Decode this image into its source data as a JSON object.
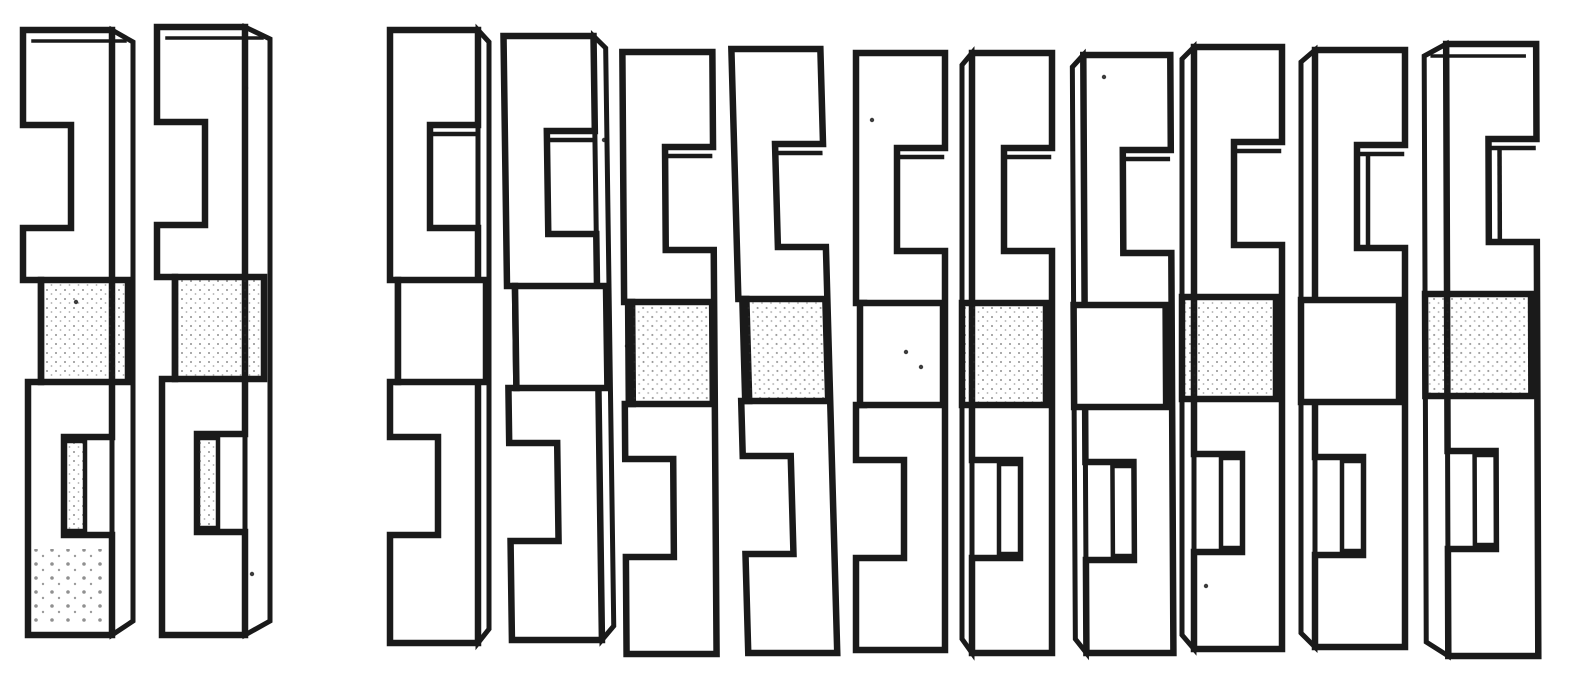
{
  "figure": {
    "kind": "interlocking-s-blocks-diagram",
    "canvas": {
      "width": 1588,
      "height": 676
    },
    "colors": {
      "paper": "#ffffff",
      "ink": "#1a1a1a",
      "stipple": "#333333"
    },
    "template": {
      "top_notch_top": 95,
      "top_notch_bottom": 198,
      "mid_top": 250,
      "mid_bottom": 352,
      "bottom_notch_top": 407,
      "bottom_notch_bottom": 505,
      "notch_depth": 48,
      "stroke": 6.5,
      "detail_stroke": 4.5,
      "thin_stroke": 3.5
    },
    "groups": {
      "left_pair_count": 2,
      "right_chain_count": 10
    },
    "pieces": [
      {
        "id": "piece-1",
        "x": 23,
        "y": 30,
        "w": 89,
        "h": 605,
        "variant": "mirror",
        "depth": "right",
        "dw": 21,
        "skew": 0,
        "shade_mid": true,
        "shade_bottom": true,
        "wall": true,
        "top_face": true
      },
      {
        "id": "piece-2",
        "x": 157,
        "y": 27,
        "w": 88,
        "h": 608,
        "variant": "mirror",
        "depth": "right",
        "dw": 25,
        "skew": 0,
        "shade_mid": true,
        "shade_bottom": false,
        "wall": true,
        "top_face": true
      },
      {
        "id": "piece-3",
        "x": 390,
        "y": 30,
        "w": 88,
        "h": 613,
        "variant": "std",
        "depth": "right",
        "dw": 11,
        "skew": 0,
        "shade_mid": false,
        "shade_bottom": false,
        "wall": false,
        "top_face": false
      },
      {
        "id": "piece-4",
        "x": 503,
        "y": 36,
        "w": 90,
        "h": 604,
        "variant": "std",
        "depth": "right",
        "dw": 12,
        "skew": 0.8,
        "shade_mid": false,
        "shade_bottom": false,
        "wall": false,
        "top_face": false
      },
      {
        "id": "piece-5",
        "x": 622,
        "y": 52,
        "w": 90,
        "h": 602,
        "variant": "std",
        "depth": "none",
        "dw": 0,
        "skew": 0.4,
        "shade_mid": true,
        "shade_bottom": false,
        "wall": false,
        "top_face": false
      },
      {
        "id": "piece-6",
        "x": 730,
        "y": 49,
        "w": 89,
        "h": 604,
        "variant": "std",
        "depth": "none",
        "dw": 0,
        "skew": 1.6,
        "shade_mid": true,
        "shade_bottom": false,
        "wall": false,
        "top_face": false
      },
      {
        "id": "piece-7",
        "x": 856,
        "y": 53,
        "w": 89,
        "h": 597,
        "variant": "std",
        "depth": "none",
        "dw": 0,
        "skew": 0,
        "shade_mid": false,
        "shade_bottom": false,
        "wall": false,
        "top_face": false
      },
      {
        "id": "piece-8",
        "x": 972,
        "y": 53,
        "w": 80,
        "h": 600,
        "variant": "std",
        "depth": "left",
        "dw": 10,
        "skew": 0,
        "shade_mid": true,
        "shade_bottom": false,
        "wall": true,
        "top_face": false
      },
      {
        "id": "piece-9",
        "x": 1083,
        "y": 55,
        "w": 87,
        "h": 598,
        "variant": "std",
        "depth": "left",
        "dw": 11,
        "skew": 0.3,
        "shade_mid": false,
        "shade_bottom": false,
        "wall": true,
        "top_face": false
      },
      {
        "id": "piece-10",
        "x": 1194,
        "y": 47,
        "w": 88,
        "h": 602,
        "variant": "std",
        "depth": "left",
        "dw": 12,
        "skew": 0,
        "shade_mid": true,
        "shade_bottom": false,
        "wall": true,
        "top_face": false
      },
      {
        "id": "piece-11",
        "x": 1315,
        "y": 50,
        "w": 90,
        "h": 597,
        "variant": "std",
        "depth": "left",
        "dw": 14,
        "skew": 0,
        "shade_mid": false,
        "shade_bottom": false,
        "wall": true,
        "top_face": false
      },
      {
        "id": "piece-12",
        "x": 1446,
        "y": 44,
        "w": 90,
        "h": 612,
        "variant": "std",
        "depth": "left",
        "dw": 22,
        "skew": 0.2,
        "shade_mid": true,
        "shade_bottom": false,
        "wall": true,
        "top_face": true
      }
    ],
    "specks": [
      [
        906,
        352
      ],
      [
        921,
        367
      ],
      [
        1104,
        77
      ],
      [
        246,
        88
      ],
      [
        76,
        302
      ],
      [
        604,
        140
      ],
      [
        627,
        346
      ],
      [
        1206,
        586
      ],
      [
        252,
        574
      ],
      [
        872,
        120
      ]
    ]
  }
}
